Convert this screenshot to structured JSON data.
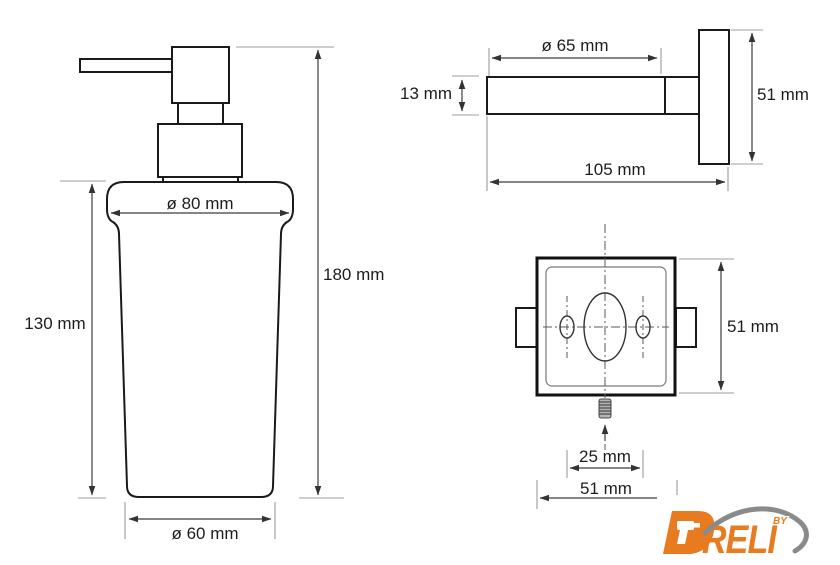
{
  "diagram": {
    "front_view": {
      "description": "soap dispenser bottle with pump, front elevation",
      "labels": {
        "top_diameter": "ø 80 mm",
        "body_height": "130 mm",
        "total_height": "180 mm",
        "bottom_diameter": "ø 60 mm"
      }
    },
    "side_view": {
      "description": "wall holder arm and plate, side elevation",
      "labels": {
        "arm_diameter": "ø 65 mm",
        "arm_thickness": "13 mm",
        "plate_height": "51 mm",
        "total_depth": "105 mm"
      }
    },
    "back_view": {
      "description": "square wall plate with screw holes, rear view",
      "labels": {
        "plate_height": "51 mm",
        "screw_spacing": "25 mm",
        "plate_width": "51 mm"
      }
    }
  },
  "logo": {
    "brand": "DRELI",
    "brand_tail": "RELI",
    "byline": "BY",
    "accent_color": "#e87b20",
    "swoosh_color": "#8a8a8a"
  },
  "colors": {
    "outline": "#1a1a1a",
    "dimension_line": "#3c3c3c",
    "extension_line": "#9c9c9c",
    "centerline": "#5a5a5a",
    "label_text": "#1d1d1d",
    "background": "#ffffff"
  }
}
